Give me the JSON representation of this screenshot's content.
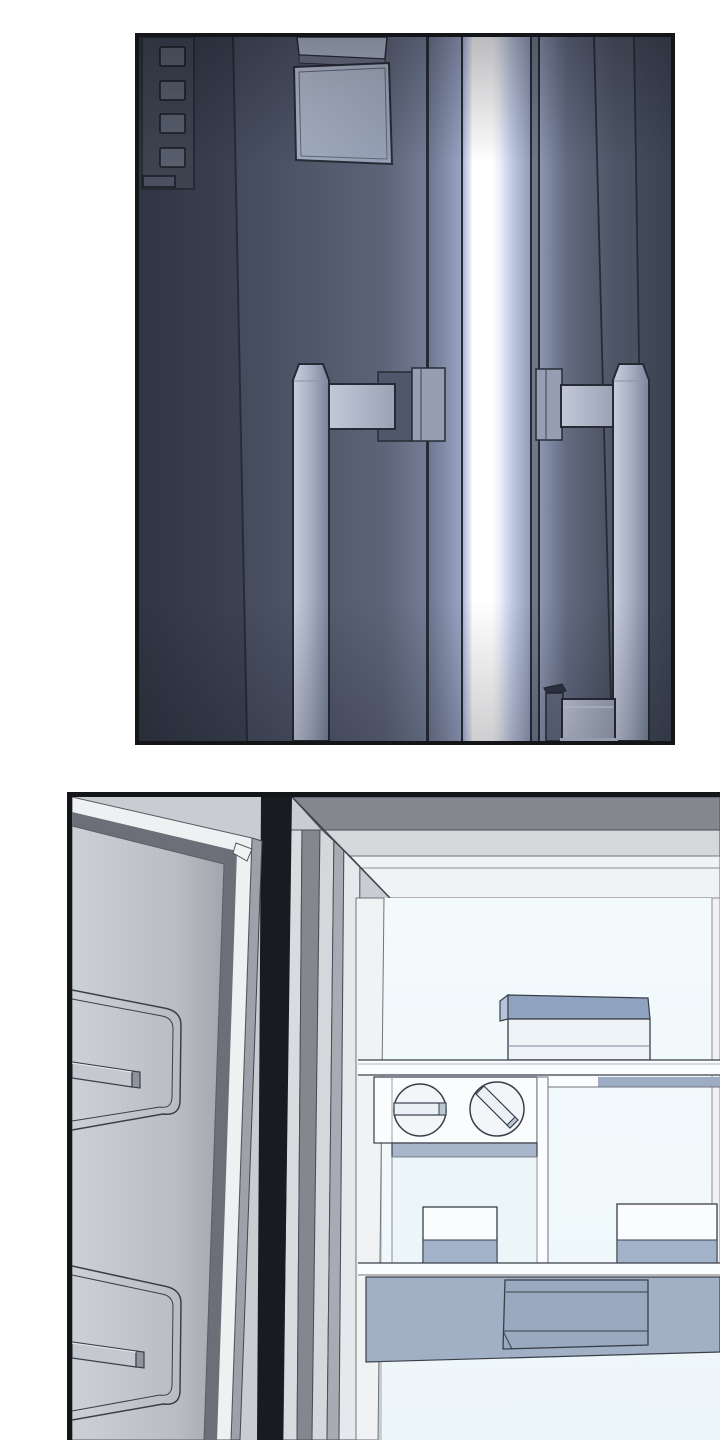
{
  "page": {
    "kind": "webtoon-comic-page",
    "background": "#ffffff",
    "panel_count": 2
  },
  "panels": [
    {
      "id": "panel-1",
      "subject": "closed-refrigerator-double-doors-with-glowing-center-seam",
      "objects": [
        {
          "name": "dispenser-control-panel",
          "button_count": 4
        },
        {
          "name": "door-display-screen"
        },
        {
          "name": "center-light-seam"
        },
        {
          "name": "left-door"
        },
        {
          "name": "right-door"
        },
        {
          "name": "left-door-handle"
        },
        {
          "name": "right-door-handle"
        },
        {
          "name": "handle-mount-brackets",
          "count": 3
        }
      ]
    },
    {
      "id": "panel-2",
      "subject": "open-refrigerator-door-revealing-interior-shelves",
      "objects": [
        {
          "name": "open-door",
          "recessed_panels": 2,
          "handle_bars": 2
        },
        {
          "name": "door-gap-shadow"
        },
        {
          "name": "cabinet-frame"
        },
        {
          "name": "top-shelf-storage-box"
        },
        {
          "name": "jar-lid-horizontal-grip"
        },
        {
          "name": "jar-lid-diagonal-grip"
        },
        {
          "name": "drawer-compartment-left"
        },
        {
          "name": "small-container-left"
        },
        {
          "name": "small-container-right"
        },
        {
          "name": "bottom-drawer-front"
        }
      ]
    }
  ],
  "colors": {
    "ink": "#141519",
    "paper": "#ffffff",
    "line": "#272b35",
    "line2": "#3a3e49",
    "line-soft": "#6f737c",
    "p1-door-left-dark": "#363c4b",
    "p1-door-left": "#4b5264",
    "p1-door-left-light": "#737d95",
    "p1-door-right-light": "#8c96b1",
    "p1-door-right": "#49505f",
    "p1-door-right-dark": "#3a4150",
    "p1-seam-glow": "#9aa5c4",
    "p1-light-core": "#ffffff",
    "p1-light-halo": "#dde2f3",
    "p1-light-fade": "#939db9",
    "p1-dispenser": "#3e4350",
    "p1-dispenser-button": "#575e6d",
    "p1-display-top": "#aab3c6",
    "p1-display": "#b9c2d3",
    "p1-display-dark": "#98a2b6",
    "p1-handle-light": "#c8cfdf",
    "p1-handle-mid": "#aab2c5",
    "p1-handle-dark": "#79839a",
    "p1-plate-dark": "#505768",
    "p1-plate-light": "#969eb1",
    "p2-base": "#c9ccd1",
    "p2-door-face": "#cdd0d5",
    "p2-door-face-dark": "#a2a5ad",
    "p2-door-molding-dark": "#6c6f78",
    "p2-door-molding-light": "#eef0f2",
    "p2-door-edge": "#9ea1a9",
    "p2-gap": "#191b20",
    "p2-frame-dark": "#84878e",
    "p2-frame-light": "#d5d7db",
    "p2-frame-mid": "#a8abb2",
    "p2-frame-lighter": "#e7e8eb",
    "p2-liner": "#f1f2f4",
    "p2-interior": "#edf6f9",
    "p2-interior-light": "#f3fafc",
    "p2-shelf": "#fbfcfd",
    "p2-item-top": "#8fa2bf",
    "p2-item-side": "#b7c3d8",
    "p2-item-front": "#eef3f8",
    "p2-box-front": "#fafcfd",
    "p2-box-band": "#a2b2c8",
    "p2-drawer-band": "#a8b6cb",
    "p2-shadow-band": "#9dacc2",
    "p2-bottom-drawer": "#a2b0c5",
    "p2-bottom-drawer-recess": "#9aa9bf",
    "p2-jar-face": "#f2f6f9",
    "p2-jar-grip": "#eaf0f5",
    "p2-jar-grip-cap": "#b9c6d4",
    "p2-door-bar": "#c5c8ce",
    "p2-door-bar-cap": "#8f939c"
  }
}
